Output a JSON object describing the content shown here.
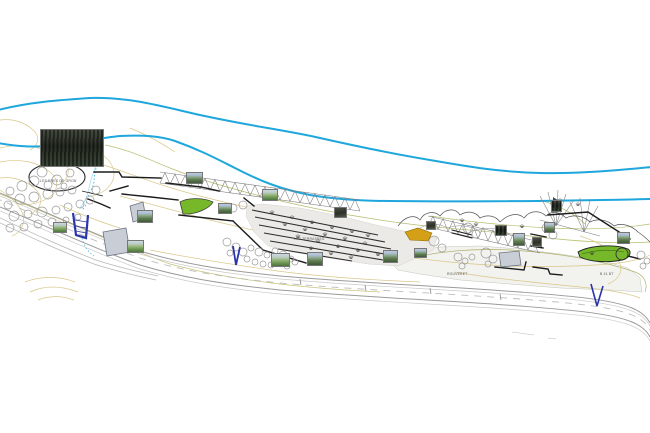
{
  "plan": {
    "background": "#ffffff",
    "labels": {
      "area_left": "LES PRES DE GRON",
      "area_center": "LES TERRASSES",
      "area_right": "ROUVERET",
      "parcel_right": "B 41 BT"
    },
    "colors": {
      "river_blue": "#1fa7dd",
      "stream_blue": "#3db5e6",
      "contour_tan": "#d9c789",
      "contour_olive": "#b6bd6d",
      "wall_black": "#1c1c1c",
      "lawn_green": "#76b82a",
      "ochre_patch": "#d4a017",
      "marker_blue": "#2a35a8",
      "road_gray": "#9a9a9a",
      "building_gray": "#c9ced6",
      "terrace_fill": "#eceae6"
    },
    "counts": {
      "rivers": 2,
      "photo_thumbnails": 19,
      "green_areas": 2,
      "buildings": 3,
      "blue_markers": 3
    }
  }
}
